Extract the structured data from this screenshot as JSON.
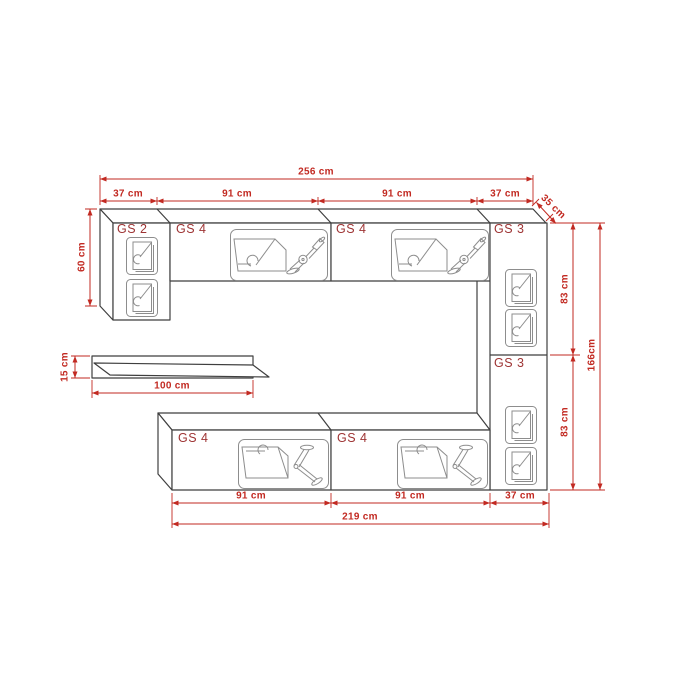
{
  "diagram": {
    "kind": "furniture wall unit dimensional drawing",
    "units": "cm"
  },
  "colors": {
    "background": "#ffffff",
    "cabinet_outline": "#3f3f3f",
    "icon_line": "#8d8d8d",
    "dimension_red": "#c22a22",
    "cabinet_label_red": "#9e3434"
  },
  "cabinet_labels": {
    "top_left": "GS 2",
    "top_mid_left": "GS 4",
    "top_mid_right": "GS 4",
    "top_right": "GS 3",
    "right_lower": "GS 3",
    "bottom_left": "GS 4",
    "bottom_right": "GS 4"
  },
  "dimensions": {
    "total_width_top": "256 cm",
    "top_segment_1": "37 cm",
    "top_segment_2": "91 cm",
    "top_segment_3": "91 cm",
    "top_segment_4": "37 cm",
    "depth": "35 cm",
    "left_cabinet_height": "60 cm",
    "shelf_height": "15 cm",
    "shelf_width": "100 cm",
    "right_upper_height": "83 cm",
    "right_lower_height": "83 cm",
    "total_height": "166cm",
    "bottom_segment_1": "91 cm",
    "bottom_segment_2": "91 cm",
    "bottom_segment_3": "37 cm",
    "total_width_bottom": "219 cm"
  },
  "icons": {
    "door": "open-door-icon",
    "flap": "drop-down-flap-icon",
    "bracket": "wall-bracket-icon"
  }
}
